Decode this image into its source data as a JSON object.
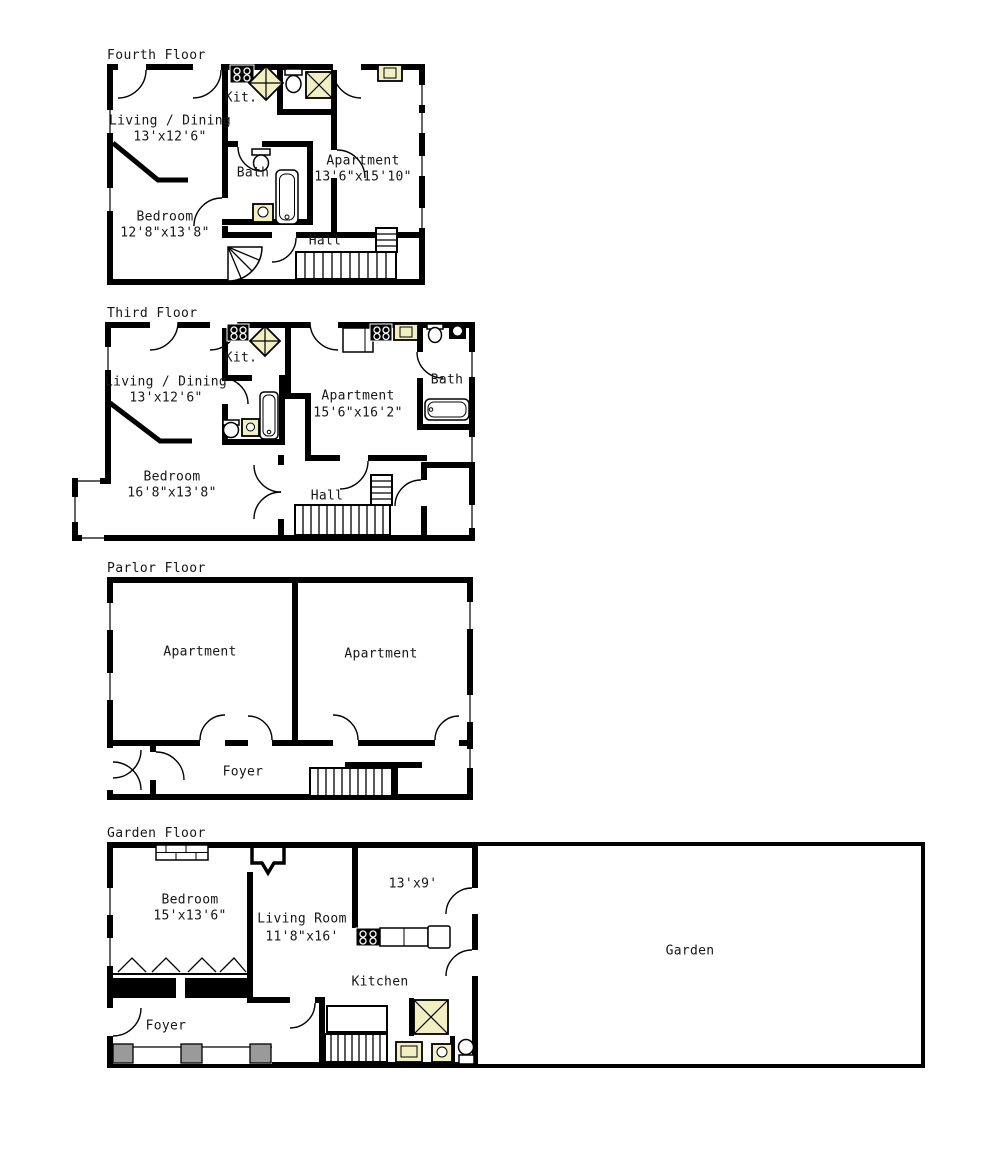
{
  "colors": {
    "wall": "#000000",
    "background": "#ffffff",
    "skylight_fill": "#f2efc3",
    "pier_gray": "#9a9a9a"
  },
  "icons": {
    "stove-icon": "black range with 4 burner rings",
    "skylight-icon": "yellow square with X",
    "diamond-skylight-icon": "yellow diamond with cross",
    "toilet-icon": "tank with oval bowl",
    "bathtub-icon": "rounded rectangle tub",
    "sink-icon": "yellow basin",
    "stairs-icon": "striped stair run",
    "winder-stairs-icon": "quarter-circle fan stair",
    "door-icon": "quarter-circle swing arc",
    "fireplace-icon": "brick hearth",
    "closet-rod-icon": "zigzag hanger row",
    "window-icon": "thin line gap in wall"
  },
  "floors": {
    "fourth": {
      "title": "Fourth Floor",
      "living_name": "Living / Dining",
      "living_dims": "13'x12'6\"",
      "kit_label": "Kit.",
      "bath_label": "Bath",
      "apartment_name": "Apartment",
      "apartment_dims": "13'6\"x15'10\"",
      "bedroom_name": "Bedroom",
      "bedroom_dims": "12'8\"x13'8\"",
      "hall_label": "Hall"
    },
    "third": {
      "title": "Third Floor",
      "living_name": "Living / Dining",
      "living_dims": "13'x12'6\"",
      "kit_label": "Kit.",
      "apartment_name": "Apartment",
      "apartment_dims": "15'6\"x16'2\"",
      "bath_label": "Bath",
      "bedroom_name": "Bedroom",
      "bedroom_dims": "16'8\"x13'8\"",
      "hall_label": "Hall"
    },
    "parlor": {
      "title": "Parlor Floor",
      "apartment_left": "Apartment",
      "apartment_right": "Apartment",
      "foyer_label": "Foyer"
    },
    "garden": {
      "title": "Garden Floor",
      "bedroom_name": "Bedroom",
      "bedroom_dims": "15'x13'6\"",
      "living_name": "Living Room",
      "living_dims": "11'8\"x16'",
      "small_room_dims": "13'x9'",
      "kitchen_label": "Kitchen",
      "foyer_label": "Foyer",
      "garden_label": "Garden"
    }
  }
}
